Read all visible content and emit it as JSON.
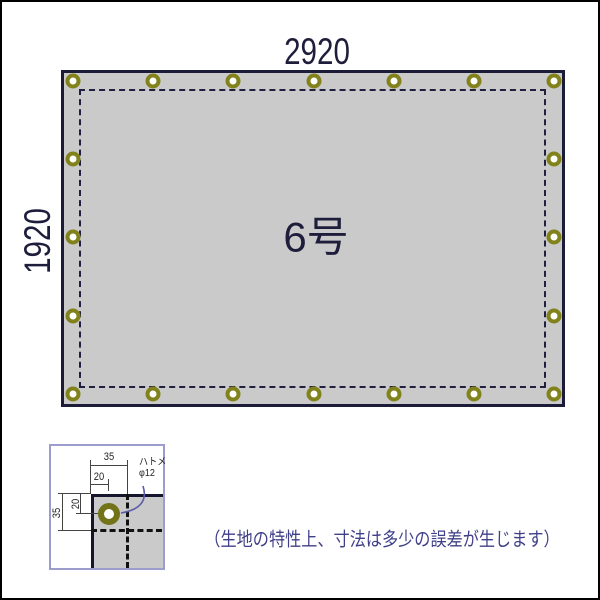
{
  "main_diagram": {
    "width_label": "2920",
    "height_label": "1920",
    "center_label": "6号",
    "tarp_fill": "#cacaca",
    "tarp_border": "#1c1c38",
    "grommets": {
      "ring_color": "#82821c",
      "top_y": 79,
      "bottom_y": 392,
      "left_x": 71,
      "right_x": 552,
      "row_x": [
        71,
        151,
        231,
        312,
        392,
        472,
        552
      ],
      "side_y": [
        157,
        235,
        314
      ]
    }
  },
  "detail_diagram": {
    "box_border_color": "#9d9dcd",
    "grommet_ring_color": "#73731a",
    "labels": {
      "top_35": "35",
      "top_20": "20",
      "left_35": "35",
      "left_20": "20"
    },
    "grommet_note": {
      "line1": "ハトメ",
      "line2": "φ12"
    },
    "leader_color": "#5a5aaa"
  },
  "note": {
    "text": "（生地の特性上、寸法は多少の誤差が生じます）",
    "color": "#3f3f8a"
  }
}
